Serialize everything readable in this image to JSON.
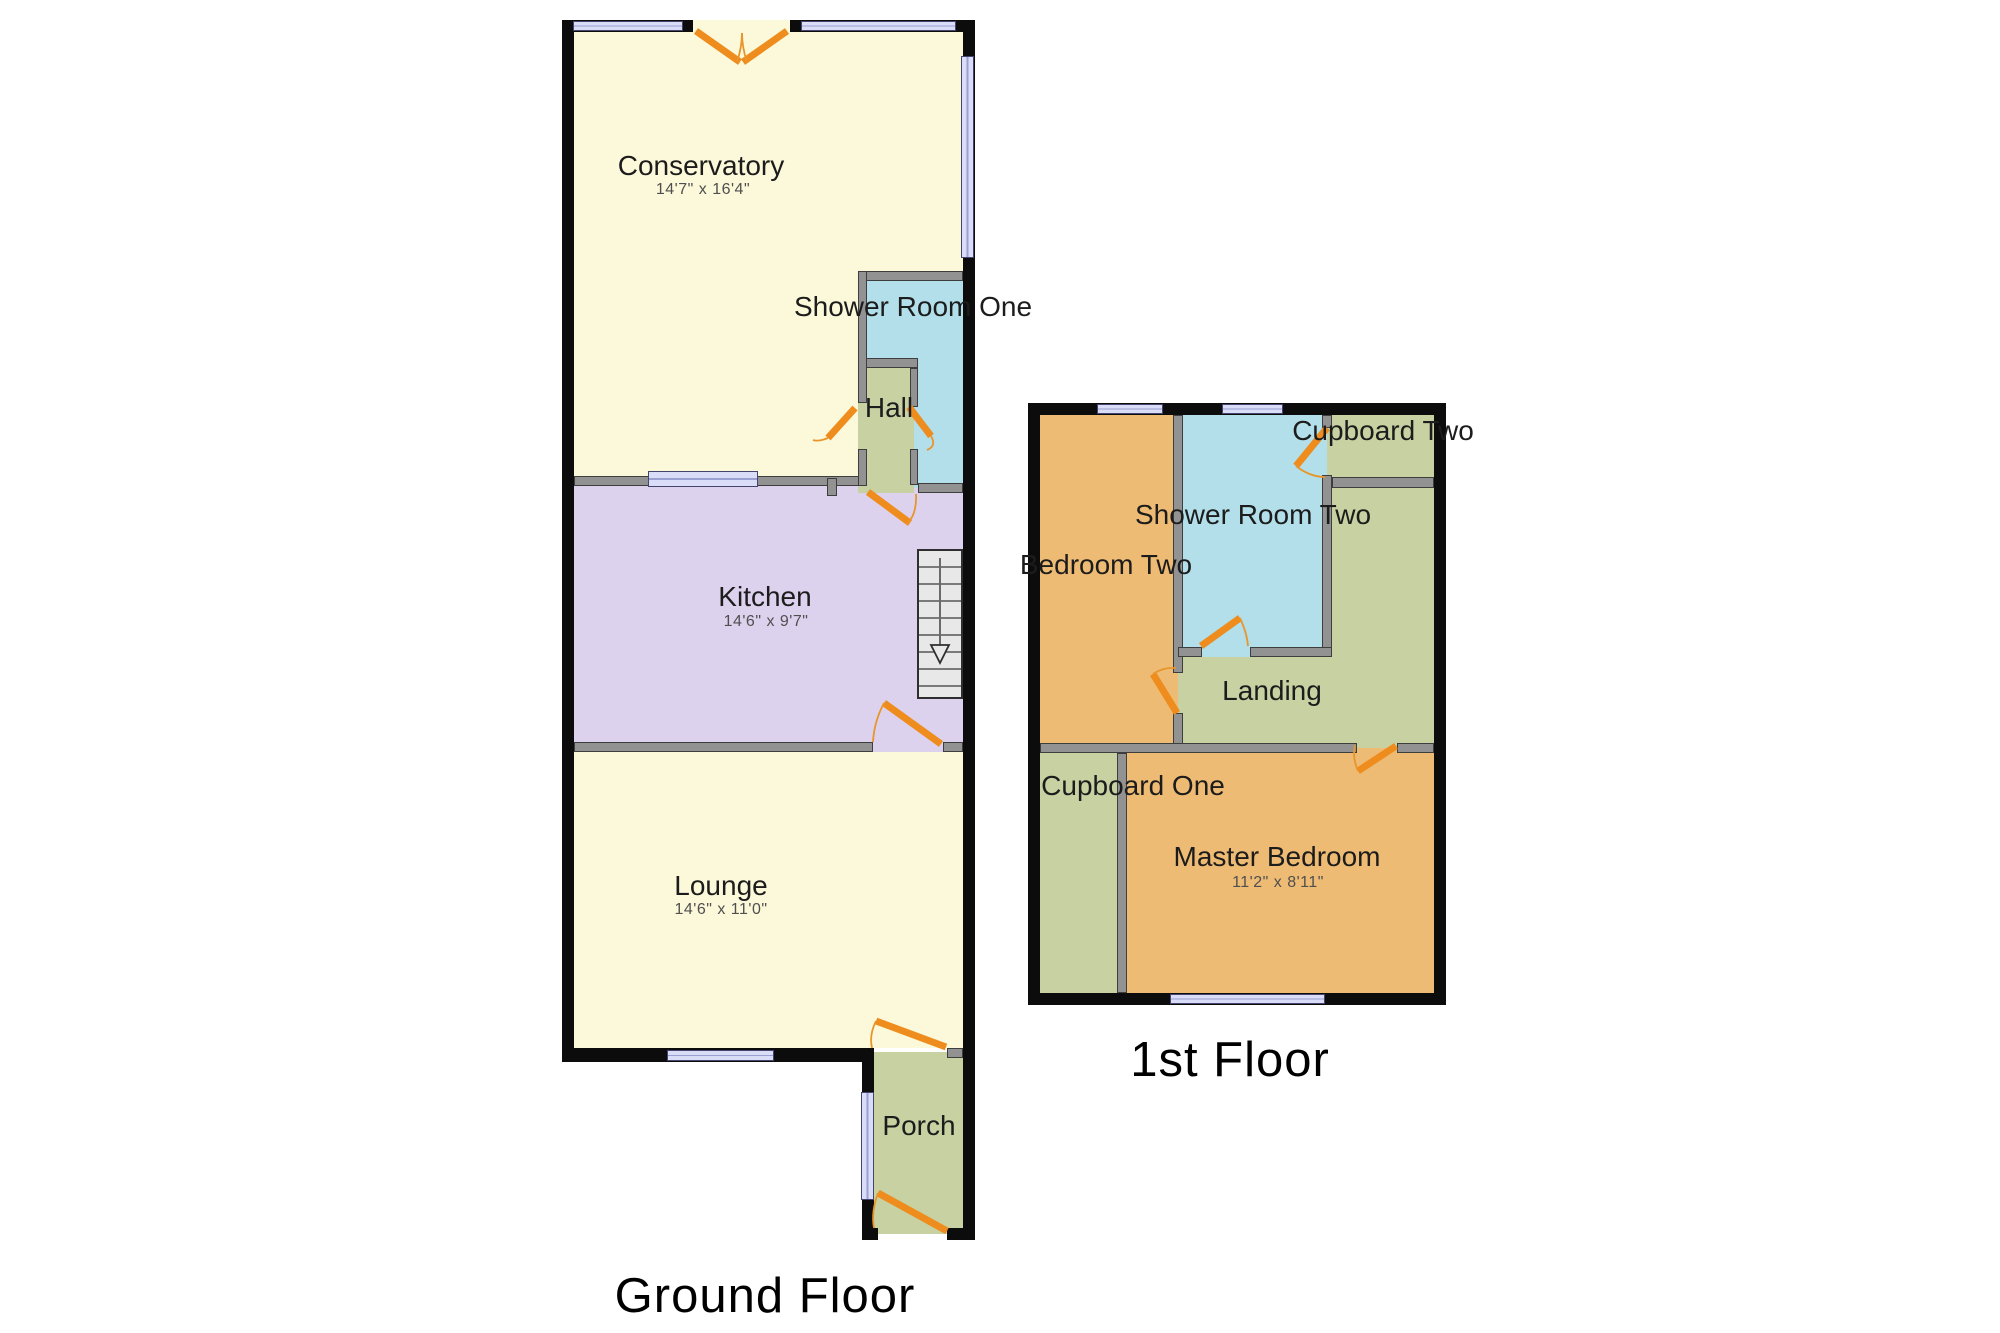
{
  "ground_floor": {
    "title": "Ground Floor",
    "rooms": {
      "conservatory": {
        "name": "Conservatory",
        "dims": "14'7\" x 16'4\""
      },
      "shower_room_one": {
        "name": "Shower Room One"
      },
      "hall": {
        "name": "Hall"
      },
      "kitchen": {
        "name": "Kitchen",
        "dims": "14'6\" x 9'7\""
      },
      "lounge": {
        "name": "Lounge",
        "dims": "14'6\" x 11'0\""
      },
      "porch": {
        "name": "Porch"
      }
    },
    "stairs": {
      "direction": "down"
    }
  },
  "first_floor": {
    "title": "1st Floor",
    "rooms": {
      "bedroom_two": {
        "name": "Bedroom Two"
      },
      "shower_room_two": {
        "name": "Shower Room Two"
      },
      "cupboard_two": {
        "name": "Cupboard Two"
      },
      "landing": {
        "name": "Landing"
      },
      "cupboard_one": {
        "name": "Cupboard One"
      },
      "master_bedroom": {
        "name": "Master Bedroom",
        "dims": "11'2\" x 8'11\""
      }
    }
  },
  "colors": {
    "room_cream": "#fcf8da",
    "room_purple": "#ddd2ee",
    "room_blue": "#b2dfe9",
    "room_green": "#c7d1a2",
    "room_orange": "#eebb74",
    "wall_black": "#0c0c0c",
    "wall_gray": "#929292",
    "window_fill": "#d9ddf8",
    "door_orange": "#ee8d1d"
  }
}
